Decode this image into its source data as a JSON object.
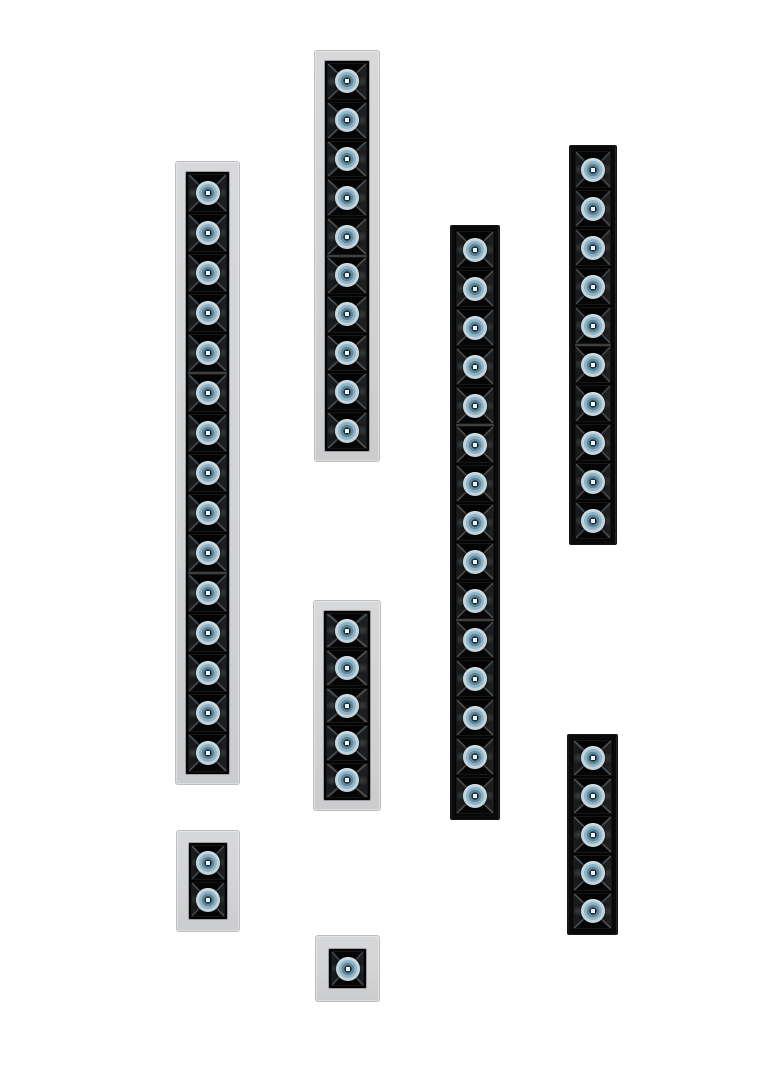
{
  "scene": {
    "subject": "recessed-linear-led-spotlight-modules-product-photo",
    "background_color": "#ffffff",
    "canvas": {
      "width": 774,
      "height": 1080
    }
  },
  "palette": {
    "white_frame": "#d2d3d5",
    "white_frame_edge": "#bdbec0",
    "black_frame": "#0a0a0b",
    "reflector_black": "#050506",
    "facet_highlight": "#1c1e1f",
    "facet_edge_line": "#949ca1",
    "lens_outer_ring": "#c2d3dc",
    "lens_mid_ring": "#8fb3c4",
    "lens_inner_ring": "#5d879c",
    "lens_center": "#22313a",
    "lens_center_dot": "#edf3f6",
    "module_seam": "#3d4043"
  },
  "fixtures": [
    {
      "id": "strip-white-15-cell",
      "frame": "white",
      "cells": 15,
      "module_size": 5,
      "x": 175,
      "y": 161,
      "width": 65,
      "height": 624,
      "frame_px": 10
    },
    {
      "id": "strip-white-10-cell",
      "frame": "white",
      "cells": 10,
      "module_size": 5,
      "x": 314,
      "y": 50,
      "width": 66,
      "height": 412,
      "frame_px": 10
    },
    {
      "id": "strip-white-5-cell",
      "frame": "white",
      "cells": 5,
      "module_size": 5,
      "x": 313,
      "y": 600,
      "width": 68,
      "height": 211,
      "frame_px": 10
    },
    {
      "id": "strip-black-15-cell",
      "frame": "black",
      "cells": 15,
      "module_size": 5,
      "x": 450,
      "y": 225,
      "width": 50,
      "height": 595,
      "frame_px": 4
    },
    {
      "id": "strip-black-10-cell",
      "frame": "black",
      "cells": 10,
      "module_size": 5,
      "x": 569,
      "y": 145,
      "width": 48,
      "height": 400,
      "frame_px": 4
    },
    {
      "id": "strip-black-5-cell",
      "frame": "black",
      "cells": 5,
      "module_size": 5,
      "x": 567,
      "y": 734,
      "width": 51,
      "height": 201,
      "frame_px": 4
    },
    {
      "id": "unit-white-2-cell",
      "frame": "white",
      "cells": 2,
      "module_size": 2,
      "x": 176,
      "y": 830,
      "width": 64,
      "height": 102,
      "frame_px": 12
    },
    {
      "id": "unit-white-1-cell",
      "frame": "white",
      "cells": 1,
      "module_size": 1,
      "x": 315,
      "y": 935,
      "width": 65,
      "height": 67,
      "frame_px": 13
    }
  ]
}
